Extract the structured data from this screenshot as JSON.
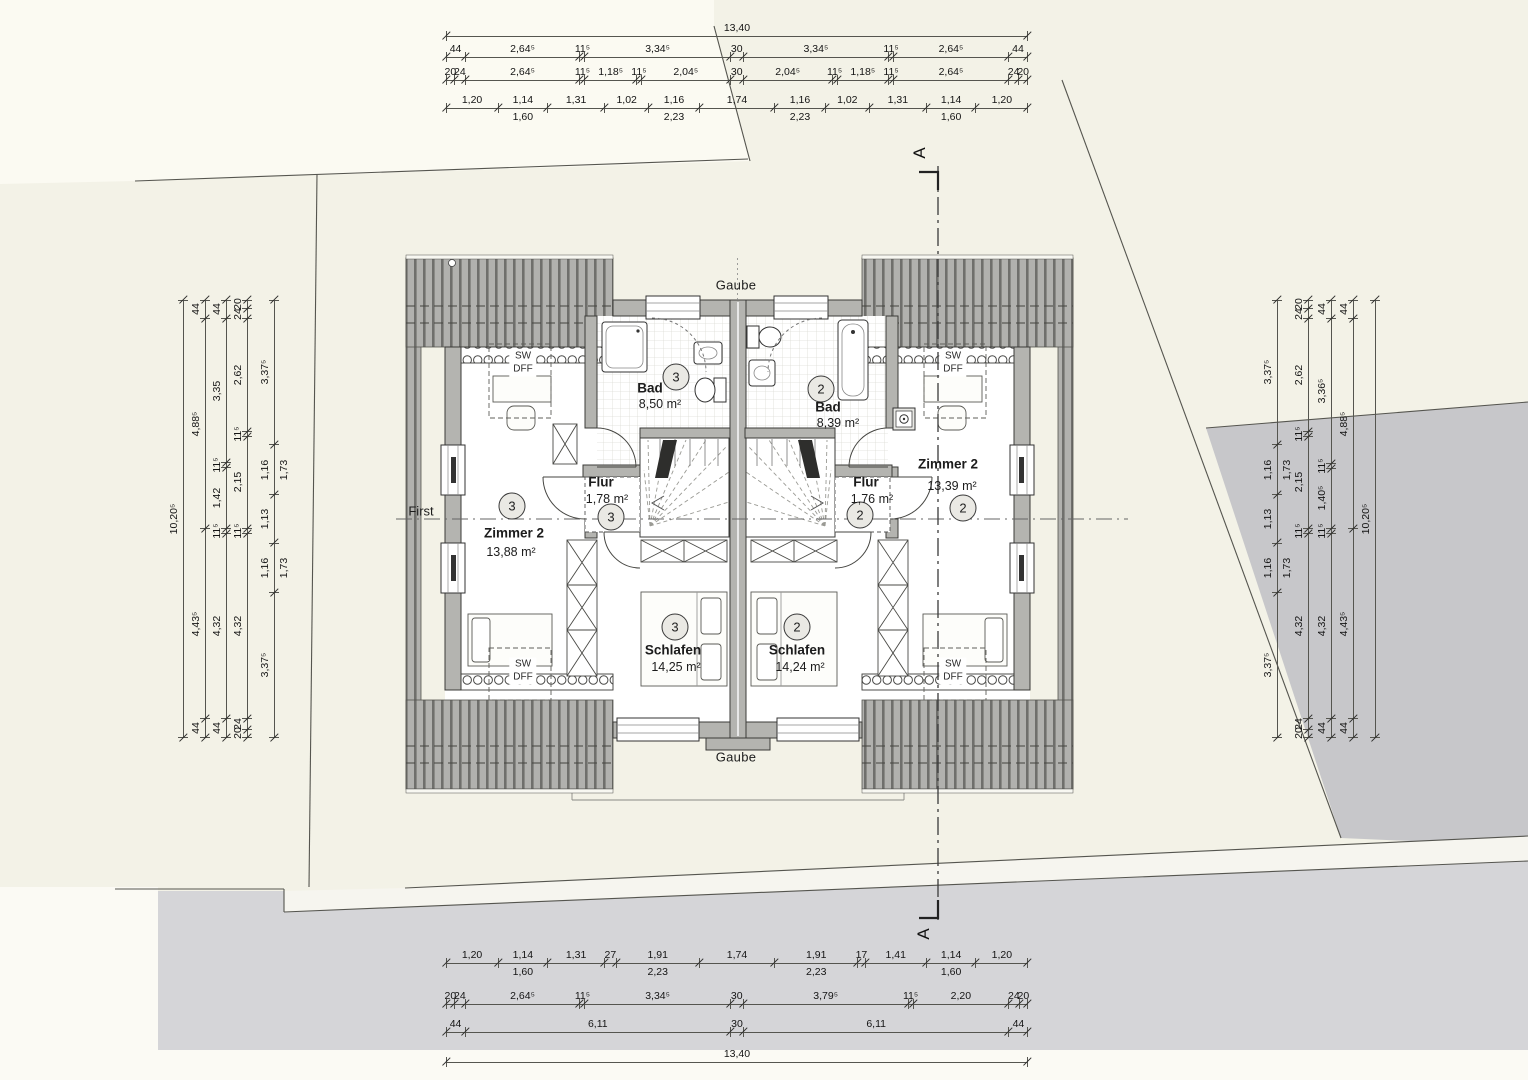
{
  "drawing": {
    "type": "attic floor plan, semi-detached house (Dachgeschoss Doppelhaus)",
    "colors": {
      "paper": "#f3f2e7",
      "paper_light": "#fbfaf2",
      "wall_fill": "#b4b4b0",
      "roof_fill": "#b1b1ae",
      "roof_stripe": "#6f6f6c",
      "neighbor_area": "#c7c7ca",
      "street": "#d5d5d8",
      "line": "#3b3b38"
    }
  },
  "plan": {
    "annotations": {
      "gaube": "Gaube",
      "ridge": "First",
      "section": "A",
      "skylight1": "SW",
      "skylight2": "DFF"
    },
    "rooms": [
      {
        "id": "zimmer2-left",
        "unit": "3",
        "name": "Zimmer 2",
        "area": "13,88 m²"
      },
      {
        "id": "bad-left",
        "unit": "3",
        "name": "Bad",
        "area": "8,50 m²"
      },
      {
        "id": "flur-left",
        "unit": "3",
        "name": "Flur",
        "area": "1,78 m²"
      },
      {
        "id": "schlafen-left",
        "unit": "3",
        "name": "Schlafen",
        "area": "14,25 m²"
      },
      {
        "id": "zimmer2-right",
        "unit": "2",
        "name": "Zimmer 2",
        "area": "13,39 m²"
      },
      {
        "id": "bad-right",
        "unit": "2",
        "name": "Bad",
        "area": "8,39 m²"
      },
      {
        "id": "flur-right",
        "unit": "2",
        "name": "Flur",
        "area": "1,76 m²"
      },
      {
        "id": "schlafen-right",
        "unit": "2",
        "name": "Schlafen",
        "area": "14,24 m²"
      }
    ]
  },
  "chains": {
    "top": [
      {
        "y": 36,
        "segs": [
          {
            "l": "13,40",
            "v": 13.4
          }
        ]
      },
      {
        "y": 57,
        "segs": [
          {
            "l": "44",
            "v": 0.44
          },
          {
            "l": "2,64⁵",
            "v": 2.645
          },
          {
            "l": "11⁵",
            "v": 0.115
          },
          {
            "l": "3,34⁵",
            "v": 3.345
          },
          {
            "l": "30",
            "v": 0.3
          },
          {
            "l": "3,34⁵",
            "v": 3.345
          },
          {
            "l": "11⁵",
            "v": 0.115
          },
          {
            "l": "2,64⁵",
            "v": 2.645
          },
          {
            "l": "44",
            "v": 0.44
          }
        ]
      },
      {
        "y": 80,
        "segs": [
          {
            "l": "20",
            "v": 0.2
          },
          {
            "l": "24",
            "v": 0.24
          },
          {
            "l": "2,64⁵",
            "v": 2.645
          },
          {
            "l": "11⁵",
            "v": 0.115
          },
          {
            "l": "1,18⁵",
            "v": 1.185
          },
          {
            "l": "11⁵",
            "v": 0.115
          },
          {
            "l": "2,04⁵",
            "v": 2.045
          },
          {
            "l": "30",
            "v": 0.3
          },
          {
            "l": "2,04⁵",
            "v": 2.045
          },
          {
            "l": "11⁵",
            "v": 0.115
          },
          {
            "l": "1,18⁵",
            "v": 1.185
          },
          {
            "l": "11⁵",
            "v": 0.115
          },
          {
            "l": "2,64⁵",
            "v": 2.645
          },
          {
            "l": "24",
            "v": 0.24
          },
          {
            "l": "20",
            "v": 0.2
          }
        ]
      },
      {
        "y": 108,
        "segs": [
          {
            "l": "1,20",
            "v": 1.2
          },
          {
            "l": "1,14",
            "v": 1.14,
            "sub": "1,60"
          },
          {
            "l": "1,31",
            "v": 1.31
          },
          {
            "l": "1,02",
            "v": 1.02
          },
          {
            "l": "1,16",
            "v": 1.16,
            "sub": "2,23"
          },
          {
            "l": "1,74",
            "v": 1.74
          },
          {
            "l": "1,16",
            "v": 1.16,
            "sub": "2,23"
          },
          {
            "l": "1,02",
            "v": 1.02
          },
          {
            "l": "1,31",
            "v": 1.31
          },
          {
            "l": "1,14",
            "v": 1.14,
            "sub": "1,60"
          },
          {
            "l": "1,20",
            "v": 1.2
          }
        ]
      }
    ],
    "bottom": [
      {
        "y": 963,
        "segs": [
          {
            "l": "1,20",
            "v": 1.2
          },
          {
            "l": "1,14",
            "v": 1.14,
            "sub": "1,60"
          },
          {
            "l": "1,31",
            "v": 1.31
          },
          {
            "l": "27",
            "v": 0.27
          },
          {
            "l": "1,91",
            "v": 1.91,
            "sub": "2,23"
          },
          {
            "l": "1,74",
            "v": 1.74
          },
          {
            "l": "1,91",
            "v": 1.91,
            "sub": "2,23"
          },
          {
            "l": "17",
            "v": 0.17
          },
          {
            "l": "1,41",
            "v": 1.41
          },
          {
            "l": "1,14",
            "v": 1.14,
            "sub": "1,60"
          },
          {
            "l": "1,20",
            "v": 1.2
          }
        ]
      },
      {
        "y": 1004,
        "segs": [
          {
            "l": "20",
            "v": 0.2
          },
          {
            "l": "24",
            "v": 0.24
          },
          {
            "l": "2,64⁵",
            "v": 2.645
          },
          {
            "l": "11⁵",
            "v": 0.115
          },
          {
            "l": "3,34⁵",
            "v": 3.345
          },
          {
            "l": "30",
            "v": 0.3
          },
          {
            "l": "3,79⁵",
            "v": 3.795
          },
          {
            "l": "11⁵",
            "v": 0.115
          },
          {
            "l": "2,20",
            "v": 2.2
          },
          {
            "l": "24",
            "v": 0.24
          },
          {
            "l": "20",
            "v": 0.2
          }
        ]
      },
      {
        "y": 1032,
        "segs": [
          {
            "l": "44",
            "v": 0.44
          },
          {
            "l": "6,11",
            "v": 6.11
          },
          {
            "l": "30",
            "v": 0.3
          },
          {
            "l": "6,11",
            "v": 6.11
          },
          {
            "l": "44",
            "v": 0.44
          }
        ]
      },
      {
        "y": 1062,
        "segs": [
          {
            "l": "13,40",
            "v": 13.4
          }
        ]
      }
    ],
    "left": [
      {
        "x": 183,
        "segs": [
          {
            "l": "10,20⁵",
            "v": 10.205
          }
        ]
      },
      {
        "x": 205,
        "segs": [
          {
            "l": "44",
            "v": 0.44
          },
          {
            "l": "4,88⁵",
            "v": 4.885
          },
          {
            "l": "4,43⁵",
            "v": 4.435
          },
          {
            "l": "44",
            "v": 0.44
          }
        ]
      },
      {
        "x": 226,
        "segs": [
          {
            "l": "44",
            "v": 0.44
          },
          {
            "l": "3,35",
            "v": 3.35
          },
          {
            "l": "11⁵",
            "v": 0.115
          },
          {
            "l": "1,42",
            "v": 1.42
          },
          {
            "l": "11⁵",
            "v": 0.115
          },
          {
            "l": "4,32",
            "v": 4.32
          },
          {
            "l": "44",
            "v": 0.44
          }
        ]
      },
      {
        "x": 247,
        "segs": [
          {
            "l": "20",
            "v": 0.2
          },
          {
            "l": "24",
            "v": 0.24
          },
          {
            "l": "2,62",
            "v": 2.62
          },
          {
            "l": "11⁵",
            "v": 0.115
          },
          {
            "l": "2,15",
            "v": 2.15
          },
          {
            "l": "11⁵",
            "v": 0.115
          },
          {
            "l": "4,32",
            "v": 4.32
          },
          {
            "l": "24",
            "v": 0.24
          },
          {
            "l": "20",
            "v": 0.2
          }
        ]
      },
      {
        "x": 274,
        "segs": [
          {
            "l": "3,37⁵",
            "v": 3.375
          },
          {
            "l": "1,16",
            "v": 1.16,
            "sub": "1,73"
          },
          {
            "l": "1,13",
            "v": 1.13
          },
          {
            "l": "1,16",
            "v": 1.16,
            "sub": "1,73"
          },
          {
            "l": "3,37⁵",
            "v": 3.375
          }
        ]
      }
    ],
    "right": [
      {
        "x": 1277,
        "segs": [
          {
            "l": "3,37⁵",
            "v": 3.375
          },
          {
            "l": "1,16",
            "v": 1.16,
            "sub": "1,73"
          },
          {
            "l": "1,13",
            "v": 1.13
          },
          {
            "l": "1,16",
            "v": 1.16,
            "sub": "1,73"
          },
          {
            "l": "3,37⁵",
            "v": 3.375
          }
        ]
      },
      {
        "x": 1308,
        "segs": [
          {
            "l": "20",
            "v": 0.2
          },
          {
            "l": "24",
            "v": 0.24
          },
          {
            "l": "2,62",
            "v": 2.62
          },
          {
            "l": "11⁵",
            "v": 0.115
          },
          {
            "l": "2,15",
            "v": 2.15
          },
          {
            "l": "11⁵",
            "v": 0.115
          },
          {
            "l": "4,32",
            "v": 4.32
          },
          {
            "l": "24",
            "v": 0.24
          },
          {
            "l": "20",
            "v": 0.2
          }
        ]
      },
      {
        "x": 1331,
        "segs": [
          {
            "l": "44",
            "v": 0.44
          },
          {
            "l": "3,36⁵",
            "v": 3.365
          },
          {
            "l": "11⁵",
            "v": 0.115
          },
          {
            "l": "1,40⁵",
            "v": 1.405
          },
          {
            "l": "11⁵",
            "v": 0.115
          },
          {
            "l": "4,32",
            "v": 4.32
          },
          {
            "l": "44",
            "v": 0.44
          }
        ]
      },
      {
        "x": 1353,
        "segs": [
          {
            "l": "44",
            "v": 0.44
          },
          {
            "l": "4,88⁵",
            "v": 4.885
          },
          {
            "l": "4,43⁵",
            "v": 4.435
          },
          {
            "l": "44",
            "v": 0.44
          }
        ]
      },
      {
        "x": 1375,
        "segs": [
          {
            "l": "10,20⁵",
            "v": 10.205
          }
        ]
      }
    ]
  }
}
